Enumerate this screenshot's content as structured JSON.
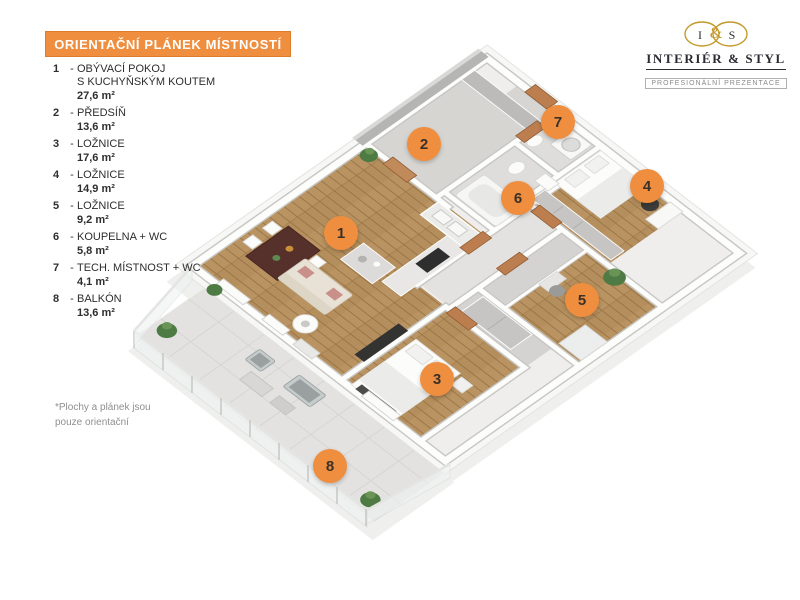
{
  "title_bar": {
    "text": "ORIENTAČNÍ PLÁNEK MÍSTNOSTÍ"
  },
  "logo": {
    "monogram": {
      "left": "I",
      "amp": "&",
      "right": "S"
    },
    "name": "INTERIÉR & STYL",
    "tagline": "PROFESIONÁLNÍ PREZENTACE"
  },
  "legend": {
    "items": [
      {
        "num": "1",
        "dash": "-",
        "name": "OBÝVACÍ POKOJ\nS KUCHYŇSKÝM KOUTEM",
        "area": "27,6 m²"
      },
      {
        "num": "2",
        "dash": "-",
        "name": "PŘEDSÍŇ",
        "area": "13,6 m²"
      },
      {
        "num": "3",
        "dash": "-",
        "name": "LOŽNICE",
        "area": "17,6 m²"
      },
      {
        "num": "4",
        "dash": "-",
        "name": "LOŽNICE",
        "area": "14,9 m²"
      },
      {
        "num": "5",
        "dash": "-",
        "name": "LOŽNICE",
        "area": "9,2 m²"
      },
      {
        "num": "6",
        "dash": "-",
        "name": "KOUPELNA + WC",
        "area": "5,8 m²"
      },
      {
        "num": "7",
        "dash": "-",
        "name": "TECH. MÍSTNOST + WC",
        "area": "4,1 m²"
      },
      {
        "num": "8",
        "dash": "-",
        "name": "BALKÓN",
        "area": "13,6 m²"
      }
    ]
  },
  "footnote": {
    "text": "*Plochy  a plánek jsou\npouze orientační"
  },
  "plan": {
    "markers": [
      {
        "label": "1",
        "x": 341,
        "y": 233
      },
      {
        "label": "2",
        "x": 424,
        "y": 144
      },
      {
        "label": "3",
        "x": 437,
        "y": 379
      },
      {
        "label": "4",
        "x": 647,
        "y": 186
      },
      {
        "label": "5",
        "x": 582,
        "y": 300
      },
      {
        "label": "6",
        "x": 518,
        "y": 198
      },
      {
        "label": "7",
        "x": 558,
        "y": 122
      },
      {
        "label": "8",
        "x": 330,
        "y": 466
      }
    ]
  },
  "colors": {
    "accent_orange": "#EF8E3E",
    "accent_orange_dark": "#DD7C2A",
    "marker_text": "#3B3128",
    "wood_floor": "#B48E5C",
    "floor_gray": "#D7D5D2",
    "wall_white": "#FDFDFB",
    "door_wood": "#BC7E4F",
    "logo_gold": "#C3992C",
    "text_dark": "#2E2E2E",
    "note_gray": "#8F8F8F"
  }
}
